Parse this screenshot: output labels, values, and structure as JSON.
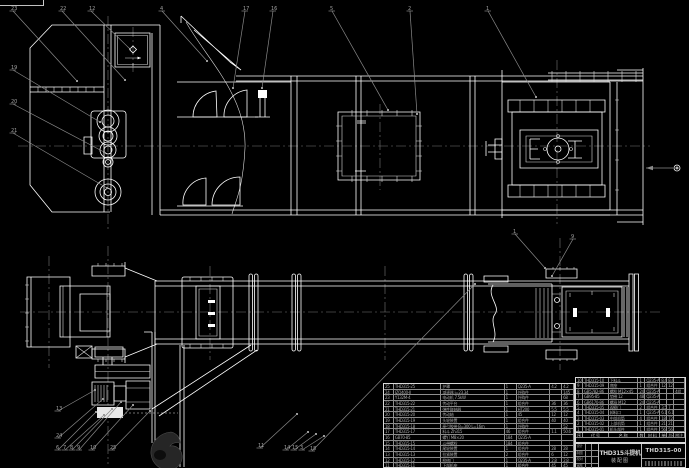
{
  "title_block": {
    "product": "THD315斗提机",
    "doc_type": "装配图",
    "drawing_no": "THD315-00",
    "sig_labels": [
      "设计",
      "制图",
      "校对",
      "审核"
    ]
  },
  "bom": {
    "header": [
      "序",
      "代  号",
      "名  称",
      "数",
      "材  料",
      "单件",
      "总计",
      "附注"
    ],
    "right_widths": [
      7,
      26,
      30,
      7,
      15,
      7,
      7,
      11
    ],
    "left_widths": [
      10,
      48,
      64,
      12,
      34,
      12,
      12
    ],
    "right_rows": [
      [
        "10",
        "THD315-10",
        "下料斗",
        "1",
        "Q235-A",
        "8.4",
        "8.4",
        ""
      ],
      [
        "9",
        "THD315-09",
        "底座",
        "1",
        "组合件",
        "12",
        "12",
        ""
      ],
      [
        "8",
        "GB5782-86",
        "螺栓 M12×45",
        "24",
        "Q235-A",
        "",
        "",
        "4组"
      ],
      [
        "7",
        "GB95-85",
        "垫圈 12",
        "48",
        "Q235-A",
        "",
        "",
        ""
      ],
      [
        "6",
        "GB6170-86",
        "螺母 M12",
        "24",
        "Q235-A",
        "",
        "",
        ""
      ],
      [
        "5",
        "THD315-05",
        "观察门",
        "2",
        "组合件",
        "3.5",
        "7",
        ""
      ],
      [
        "4",
        "THD315-04",
        "卸料口",
        "1",
        "Q235-A",
        "6.1",
        "6.1",
        ""
      ],
      [
        "3",
        "THD315-03",
        "中部机筒",
        "4",
        "组合件",
        "18",
        "72",
        ""
      ],
      [
        "2",
        "THD315-02",
        "上部机筒",
        "1",
        "组合件",
        "21",
        "21",
        ""
      ],
      [
        "1",
        "THD315-01",
        "机头部件",
        "1",
        "组合件",
        "56",
        "56",
        ""
      ]
    ],
    "left_rows": [
      [
        "25",
        "THD315-25",
        "护罩",
        "1",
        "Q235-A",
        "4.2",
        "4.2"
      ],
      [
        "24",
        "JZQ400-Ⅱ",
        "减速器 i=23.34",
        "1",
        "外购件",
        "",
        "145"
      ],
      [
        "23",
        "Y132M-4",
        "电动机 7.5kW",
        "1",
        "外购件",
        "",
        "68"
      ],
      [
        "22",
        "THD315-22",
        "传动平台",
        "1",
        "组合件",
        "36",
        "36"
      ],
      [
        "21",
        "THD315-21",
        "弹性联轴器",
        "1",
        "HT200",
        "5.5",
        "5.5"
      ],
      [
        "20",
        "THD315-20",
        "传动轴",
        "1",
        "45",
        "12",
        "12"
      ],
      [
        "19",
        "THD315-19",
        "头轮装置",
        "1",
        "组合件",
        "40",
        "40"
      ],
      [
        "18",
        "THD315-18",
        "牵引胶带 B=300 L=16m",
        "1",
        "外购件",
        "",
        "52"
      ],
      [
        "17",
        "THD315-17",
        "料斗 Zh315",
        "46",
        "组合件",
        "1.1",
        "50.6"
      ],
      [
        "16",
        "GB70-85",
        "螺钉 M8×20",
        "184",
        "Q235-A",
        "",
        ""
      ],
      [
        "15",
        "THD315-15",
        "斗带螺栓",
        "184",
        "组合件",
        "",
        ""
      ],
      [
        "14",
        "THD315-14",
        "尾轮装置",
        "1",
        "组合件",
        "28",
        "28"
      ],
      [
        "13",
        "THD315-13",
        "拉紧装置",
        "2",
        "组合件",
        "6",
        "12"
      ],
      [
        "12",
        "THD315-12",
        "检修门",
        "1",
        "Q235-A",
        "2.8",
        "2.8"
      ],
      [
        "11",
        "THD315-11",
        "下部机座",
        "1",
        "组合件",
        "45",
        "45"
      ]
    ]
  },
  "callouts": {
    "items": [
      {
        "label": "23",
        "x": 11,
        "y": 8,
        "tx": 77,
        "ty": 81
      },
      {
        "label": "22",
        "x": 60,
        "y": 8,
        "tx": 125,
        "ty": 80
      },
      {
        "label": "12",
        "x": 89,
        "y": 8,
        "tx": 130,
        "ty": 49
      },
      {
        "label": "4",
        "x": 160,
        "y": 8,
        "tx": 207,
        "ty": 61
      },
      {
        "label": "17",
        "x": 243,
        "y": 8,
        "tx": 233,
        "ty": 88
      },
      {
        "label": "16",
        "x": 271,
        "y": 8,
        "tx": 262,
        "ty": 88
      },
      {
        "label": "5",
        "x": 330,
        "y": 8,
        "tx": 388,
        "ty": 110
      },
      {
        "label": "2",
        "x": 408,
        "y": 8,
        "tx": 417,
        "ty": 114
      },
      {
        "label": "1",
        "x": 486,
        "y": 8,
        "tx": 536,
        "ty": 97
      },
      {
        "label": "19",
        "x": 11,
        "y": 67,
        "tx": 100,
        "ty": 122
      },
      {
        "label": "20",
        "x": 11,
        "y": 101,
        "tx": 104,
        "ty": 152
      },
      {
        "label": "21",
        "x": 11,
        "y": 130,
        "tx": 107,
        "ty": 188
      },
      {
        "label": "13",
        "x": 56,
        "y": 408,
        "tx": 95,
        "ty": 390
      },
      {
        "label": "24",
        "x": 56,
        "y": 435,
        "tx": 103,
        "ty": 399
      },
      {
        "label": "6",
        "x": 56,
        "y": 447,
        "tx": 96,
        "ty": 412
      },
      {
        "label": "7",
        "x": 63,
        "y": 447,
        "tx": 104,
        "ty": 415
      },
      {
        "label": "8",
        "x": 70,
        "y": 447,
        "tx": 112,
        "ty": 409
      },
      {
        "label": "9",
        "x": 77,
        "y": 447,
        "tx": 121,
        "ty": 402
      },
      {
        "label": "10",
        "x": 90,
        "y": 447,
        "tx": 133,
        "ty": 405
      },
      {
        "label": "25",
        "x": 110,
        "y": 447,
        "tx": 150,
        "ty": 411
      },
      {
        "label": "11",
        "x": 258,
        "y": 445,
        "tx": 297,
        "ty": 414
      },
      {
        "label": "14",
        "x": 284,
        "y": 447,
        "tx": 308,
        "ty": 432
      },
      {
        "label": "15",
        "x": 292,
        "y": 447,
        "tx": 316,
        "ty": 434
      },
      {
        "label": "3",
        "x": 300,
        "y": 447,
        "tx": 324,
        "ty": 436
      },
      {
        "label": "18",
        "x": 310,
        "y": 448,
        "tx": 475,
        "ty": 284
      },
      {
        "label": "1",
        "x": 513,
        "y": 231,
        "tx": 545,
        "ty": 268
      },
      {
        "label": "9",
        "x": 571,
        "y": 236,
        "tx": 552,
        "ty": 276
      }
    ]
  }
}
